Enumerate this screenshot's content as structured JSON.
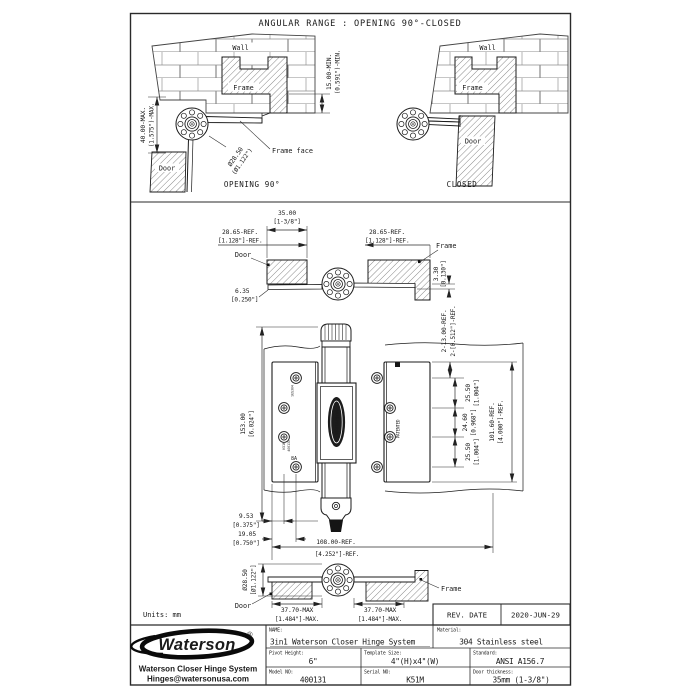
{
  "doc": {
    "title": "ANGULAR RANGE : OPENING 90°-CLOSED",
    "units": "Units: mm"
  },
  "opening90": {
    "wall": "Wall",
    "frame": "Frame",
    "door": "Door",
    "frame_face": "Frame face",
    "caption": "OPENING 90°",
    "dim_height_mm": "40.00-MAX.",
    "dim_height_in": "(1.575\")-MAX.",
    "dim_inset_mm": "15.00-MIN.",
    "dim_inset_in": "(0.591\")-MIN.",
    "dim_dia_mm": "Ø28.50",
    "dim_dia_in": "(Ø1.122\")"
  },
  "closed": {
    "wall": "Wall",
    "frame": "Frame",
    "door": "Door",
    "caption": "CLOSED"
  },
  "section_top": {
    "door": "Door",
    "frame": "Frame",
    "dim_35_mm": "35.00",
    "dim_35_in": "[1-3/8\"]",
    "dim_left_mm": "28.65-REF.",
    "dim_left_in": "[1.128\"]-REF.",
    "dim_right_mm": "28.65-REF.",
    "dim_right_in": "[1.128\"]-REF.",
    "dim_gap_mm": "3.30",
    "dim_gap_in": "[0.130\"]",
    "dim_leaf_mm": "6.35",
    "dim_leaf_in": "[0.250\"]"
  },
  "front": {
    "dim_h_mm": "153.00",
    "dim_h_in": "[6.024\"]",
    "dim_edge_mm": "2-13.00-REF.",
    "dim_edge_in": "2-[0.512\"]-REF.",
    "dim_p1_mm": "25.50",
    "dim_p1_in": "[1.004\"]",
    "dim_p2_mm": "24.60",
    "dim_p2_in": "[0.968\"]",
    "dim_p3_mm": "25.50",
    "dim_p3_in": "[1.004\"]",
    "dim_span_mm": "101.60-REF.",
    "dim_span_in": "[4.000\"]-REF.",
    "dim_s1_mm": "9.53",
    "dim_s1_in": "[0.375\"]",
    "dim_s2_mm": "19.05",
    "dim_s2_in": "[0.750\"]",
    "dim_w_mm": "108.00-REF.",
    "dim_w_in": "[4.252\"]-REF.",
    "stamp_material": "SUS304",
    "stamp_model": "K51M",
    "stamp_model2": "400131",
    "stamp_rating": "8A",
    "stamp_patented": "PATENTED",
    "barrel_logo": "Waterson"
  },
  "section_bottom": {
    "door": "Door",
    "frame": "Frame",
    "dim_dia_mm": "Ø28.50",
    "dim_dia_in": "[Ø1.122\"]",
    "dim_l_mm": "37.70-MAX",
    "dim_l_in": "[1.484\"]-MAX.",
    "dim_r_mm": "37.70-MAX",
    "dim_r_in": "[1.484\"]-MAX."
  },
  "rev": {
    "label": "REV. DATE",
    "date": "2020-JUN-29"
  },
  "tb": {
    "brand": "Waterson",
    "reg": "®",
    "company": "Waterson Closer Hinge System",
    "email": "Hinges@watersonusa.com",
    "name_l": "NAME:",
    "name_v": "3in1 Waterson Closer Hinge System",
    "mat_l": "Material:",
    "mat_v": "304 Stainless steel",
    "pivot_l": "Pivot Height:",
    "pivot_v": "6\"",
    "tmpl_l": "Template Size:",
    "tmpl_v": "4\"(H)x4\"(W)",
    "std_l": "Standard:",
    "std_v": "ANSI A156.7",
    "model_l": "Model NO:",
    "model_v": "400131",
    "serial_l": "Serial NO:",
    "serial_v": "K51M",
    "thick_l": "Door thickness:",
    "thick_v": "35mm (1-3/8\")"
  }
}
